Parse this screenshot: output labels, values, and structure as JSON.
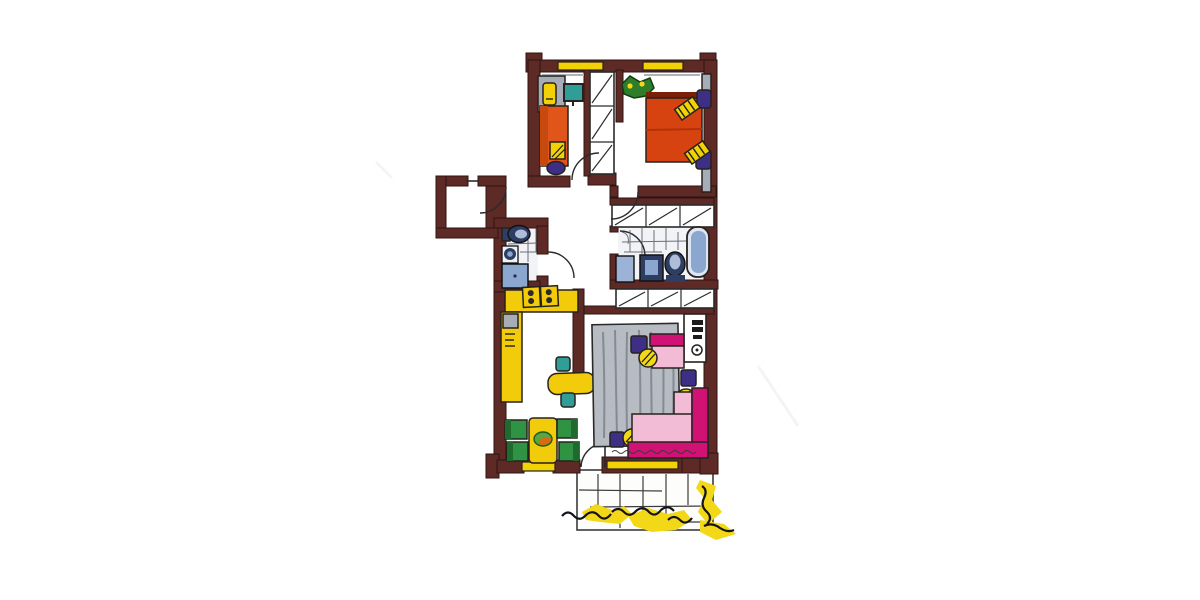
{
  "artwork": {
    "kind": "hand-drawn apartment floor plan sketch, colored marker and ink on white paper",
    "rooms": [
      {
        "name": "small bedroom / study",
        "furniture": [
          "desk",
          "yellow desk lamp",
          "teal wall monitor",
          "orange single bed",
          "striped yellow pillow",
          "purple stool at bed foot"
        ],
        "windows": 1
      },
      {
        "name": "master bedroom",
        "furniture": [
          "red double bed",
          "2 striped yellow pillows",
          "2 purple nightstands",
          "potted plant in corner",
          "2 gray wall units"
        ],
        "windows": 1
      },
      {
        "name": "entrance hall",
        "features": [
          "entry door with swing arc",
          "walled storage niche",
          "built-in closet column with 3 hatched sections",
          "upper closet row with 3 hatched sections",
          "lower closet row with 3 hatched sections"
        ]
      },
      {
        "name": "wc shower room",
        "furniture": [
          "toilet",
          "round washbasin",
          "shower tray"
        ],
        "floor": "tiled"
      },
      {
        "name": "bathroom",
        "furniture": [
          "bathtub",
          "toilet",
          "vanity sink",
          "washing machine"
        ],
        "floor": "tiled"
      },
      {
        "name": "kitchen",
        "furniture": [
          "L-shaped yellow counter",
          "stove with 4 burners",
          "gray sink",
          "oven vents",
          "yellow breakfast table",
          "2 teal chairs"
        ]
      },
      {
        "name": "dining corner",
        "furniture": [
          "yellow table",
          "fruit bowl",
          "4 green chairs"
        ],
        "windows": 1
      },
      {
        "name": "living room",
        "furniture": [
          "gray striped rug",
          "pink armchair with magenta back",
          "magenta-and-pink corner sofa",
          "3 purple side tables",
          "3 yellow round lamps",
          "white shelf unit with hi-fi"
        ],
        "windows": 1,
        "annotation": "tiny illegible handwritten note along sofa edge"
      },
      {
        "name": "balcony",
        "features": [
          "tiled floor grid",
          "yellow shrubs with black ink scribbles",
          "balcony door with swing arc"
        ]
      }
    ],
    "window_count": 4,
    "door_arc_count": 6
  },
  "palette": {
    "paper": "#ffffff",
    "wall": "#5e2a26",
    "window": "#f2d106",
    "counter": "#f2cc0a",
    "bedOrange": "#e0561a",
    "bedRed": "#d64310",
    "teal": "#2f9e96",
    "chairGreen": "#2f9343",
    "purple": "#3d2f86",
    "magenta": "#d01275",
    "pink": "#f2bcd7",
    "rug": "#b7bbc2",
    "rugStripe": "#858a94",
    "fixBlue": "#8ba6cf",
    "fixNavy": "#2e3d63",
    "grayFurn": "#a7adb6",
    "shrub": "#f2d816",
    "plantGreen": "#2e7d2a"
  }
}
